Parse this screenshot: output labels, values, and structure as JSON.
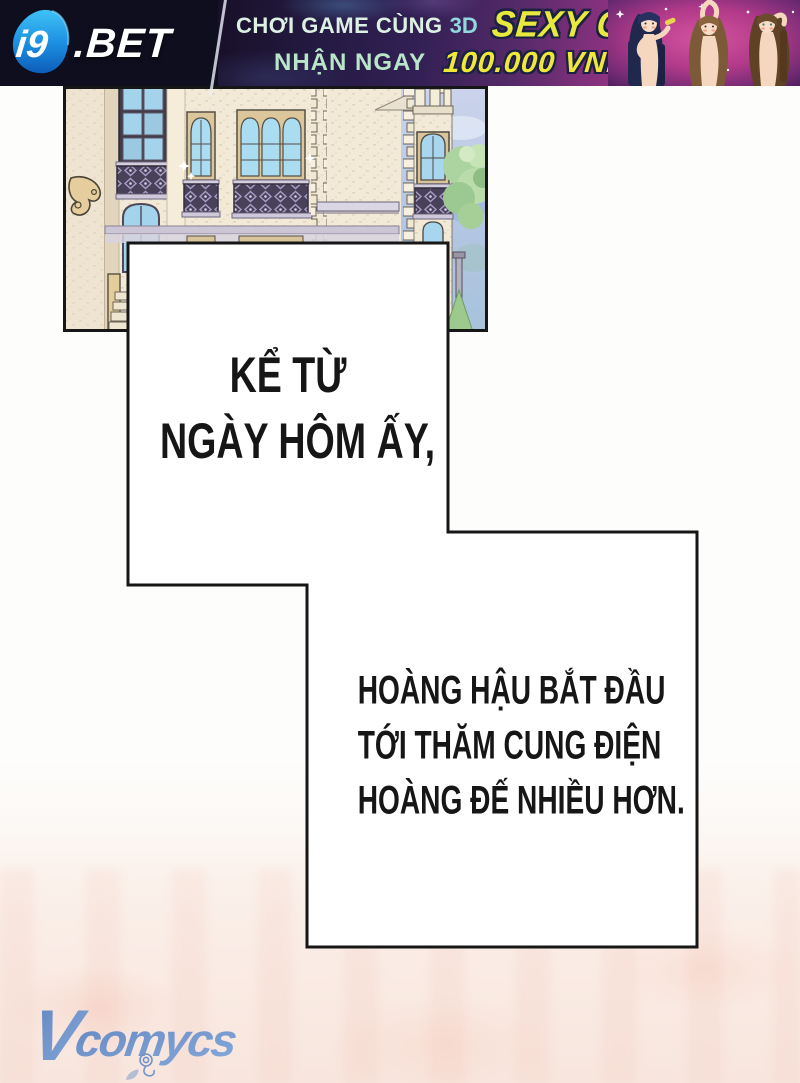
{
  "ad_banner": {
    "logo": {
      "mark": "i9",
      "name": ".BET"
    },
    "promo": {
      "line1_text": "CHƠI GAME CÙNG",
      "line1_3d": "3D",
      "line1_highlight": "SEXY GIRL",
      "line2_text": "NHẬN NGAY",
      "line2_highlight": "100.000 VND"
    },
    "colors": {
      "left_bg": "#0e0e1e",
      "mid_bg": "#332055",
      "right_bg": "#b23a8a",
      "highlight_yellow": "#e7ea3c",
      "text_mint": "#dcf0e4",
      "text_cyan": "#8fd8dc",
      "logo_blue": "#1f9ae8"
    }
  },
  "comic": {
    "narration": [
      {
        "lines": [
          "KỂ TỪ",
          "NGÀY HÔM ẤY,"
        ]
      },
      {
        "lines": [
          "HOÀNG HẬU BẮT ĐẦU",
          "TỚI THĂM CUNG ĐIỆN",
          "HOÀNG ĐẾ NHIỀU HƠN."
        ]
      }
    ],
    "panel_border_color": "#161616"
  },
  "watermark": {
    "initial": "V",
    "rest": "comycs",
    "color": "#6b8fc9"
  },
  "icons": {
    "sparkle": "✦",
    "rose": "rose-doodle"
  }
}
